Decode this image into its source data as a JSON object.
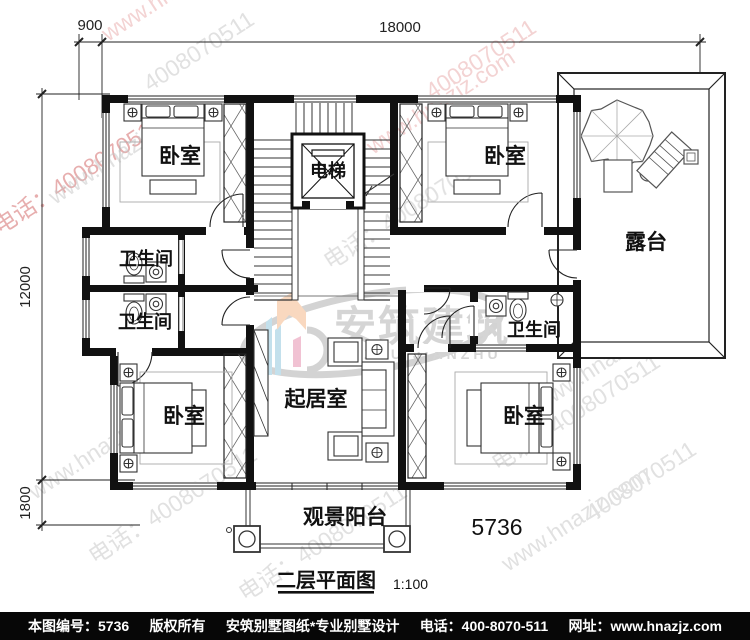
{
  "dimensions": {
    "top_offset": "900",
    "top_width": "18000",
    "left_height": "12000",
    "left_balcony": "1800"
  },
  "rooms": {
    "bedroom_tl": "卧室",
    "bedroom_tr": "卧室",
    "bedroom_bl": "卧室",
    "bedroom_br": "卧室",
    "elevator": "电梯",
    "bath_left_upper": "卫生间",
    "bath_left_lower": "卫生间",
    "bath_right": "卫生间",
    "living_room": "起居室",
    "terrace": "露台",
    "balcony": "观景阳台"
  },
  "title_block": {
    "plan_number": "5736",
    "plan_title": "二层平面图",
    "plan_scale": "1:100"
  },
  "watermark": {
    "website": "www.hnazjz.com",
    "phone": "电话：4008070511",
    "phone_digits": "4008070511",
    "logo_cn": "安筑建筑",
    "logo_en": "ANZHU JIANZHU",
    "gray": "#c2c2c2",
    "pink": "#e9a8a8",
    "red": "#d06060"
  },
  "footer": {
    "items": [
      "本图编号：5736",
      "版权所有",
      "安筑别墅图纸*专业别墅设计",
      "电话：400-8070-511",
      "网址：www.hnazjz.com"
    ]
  }
}
